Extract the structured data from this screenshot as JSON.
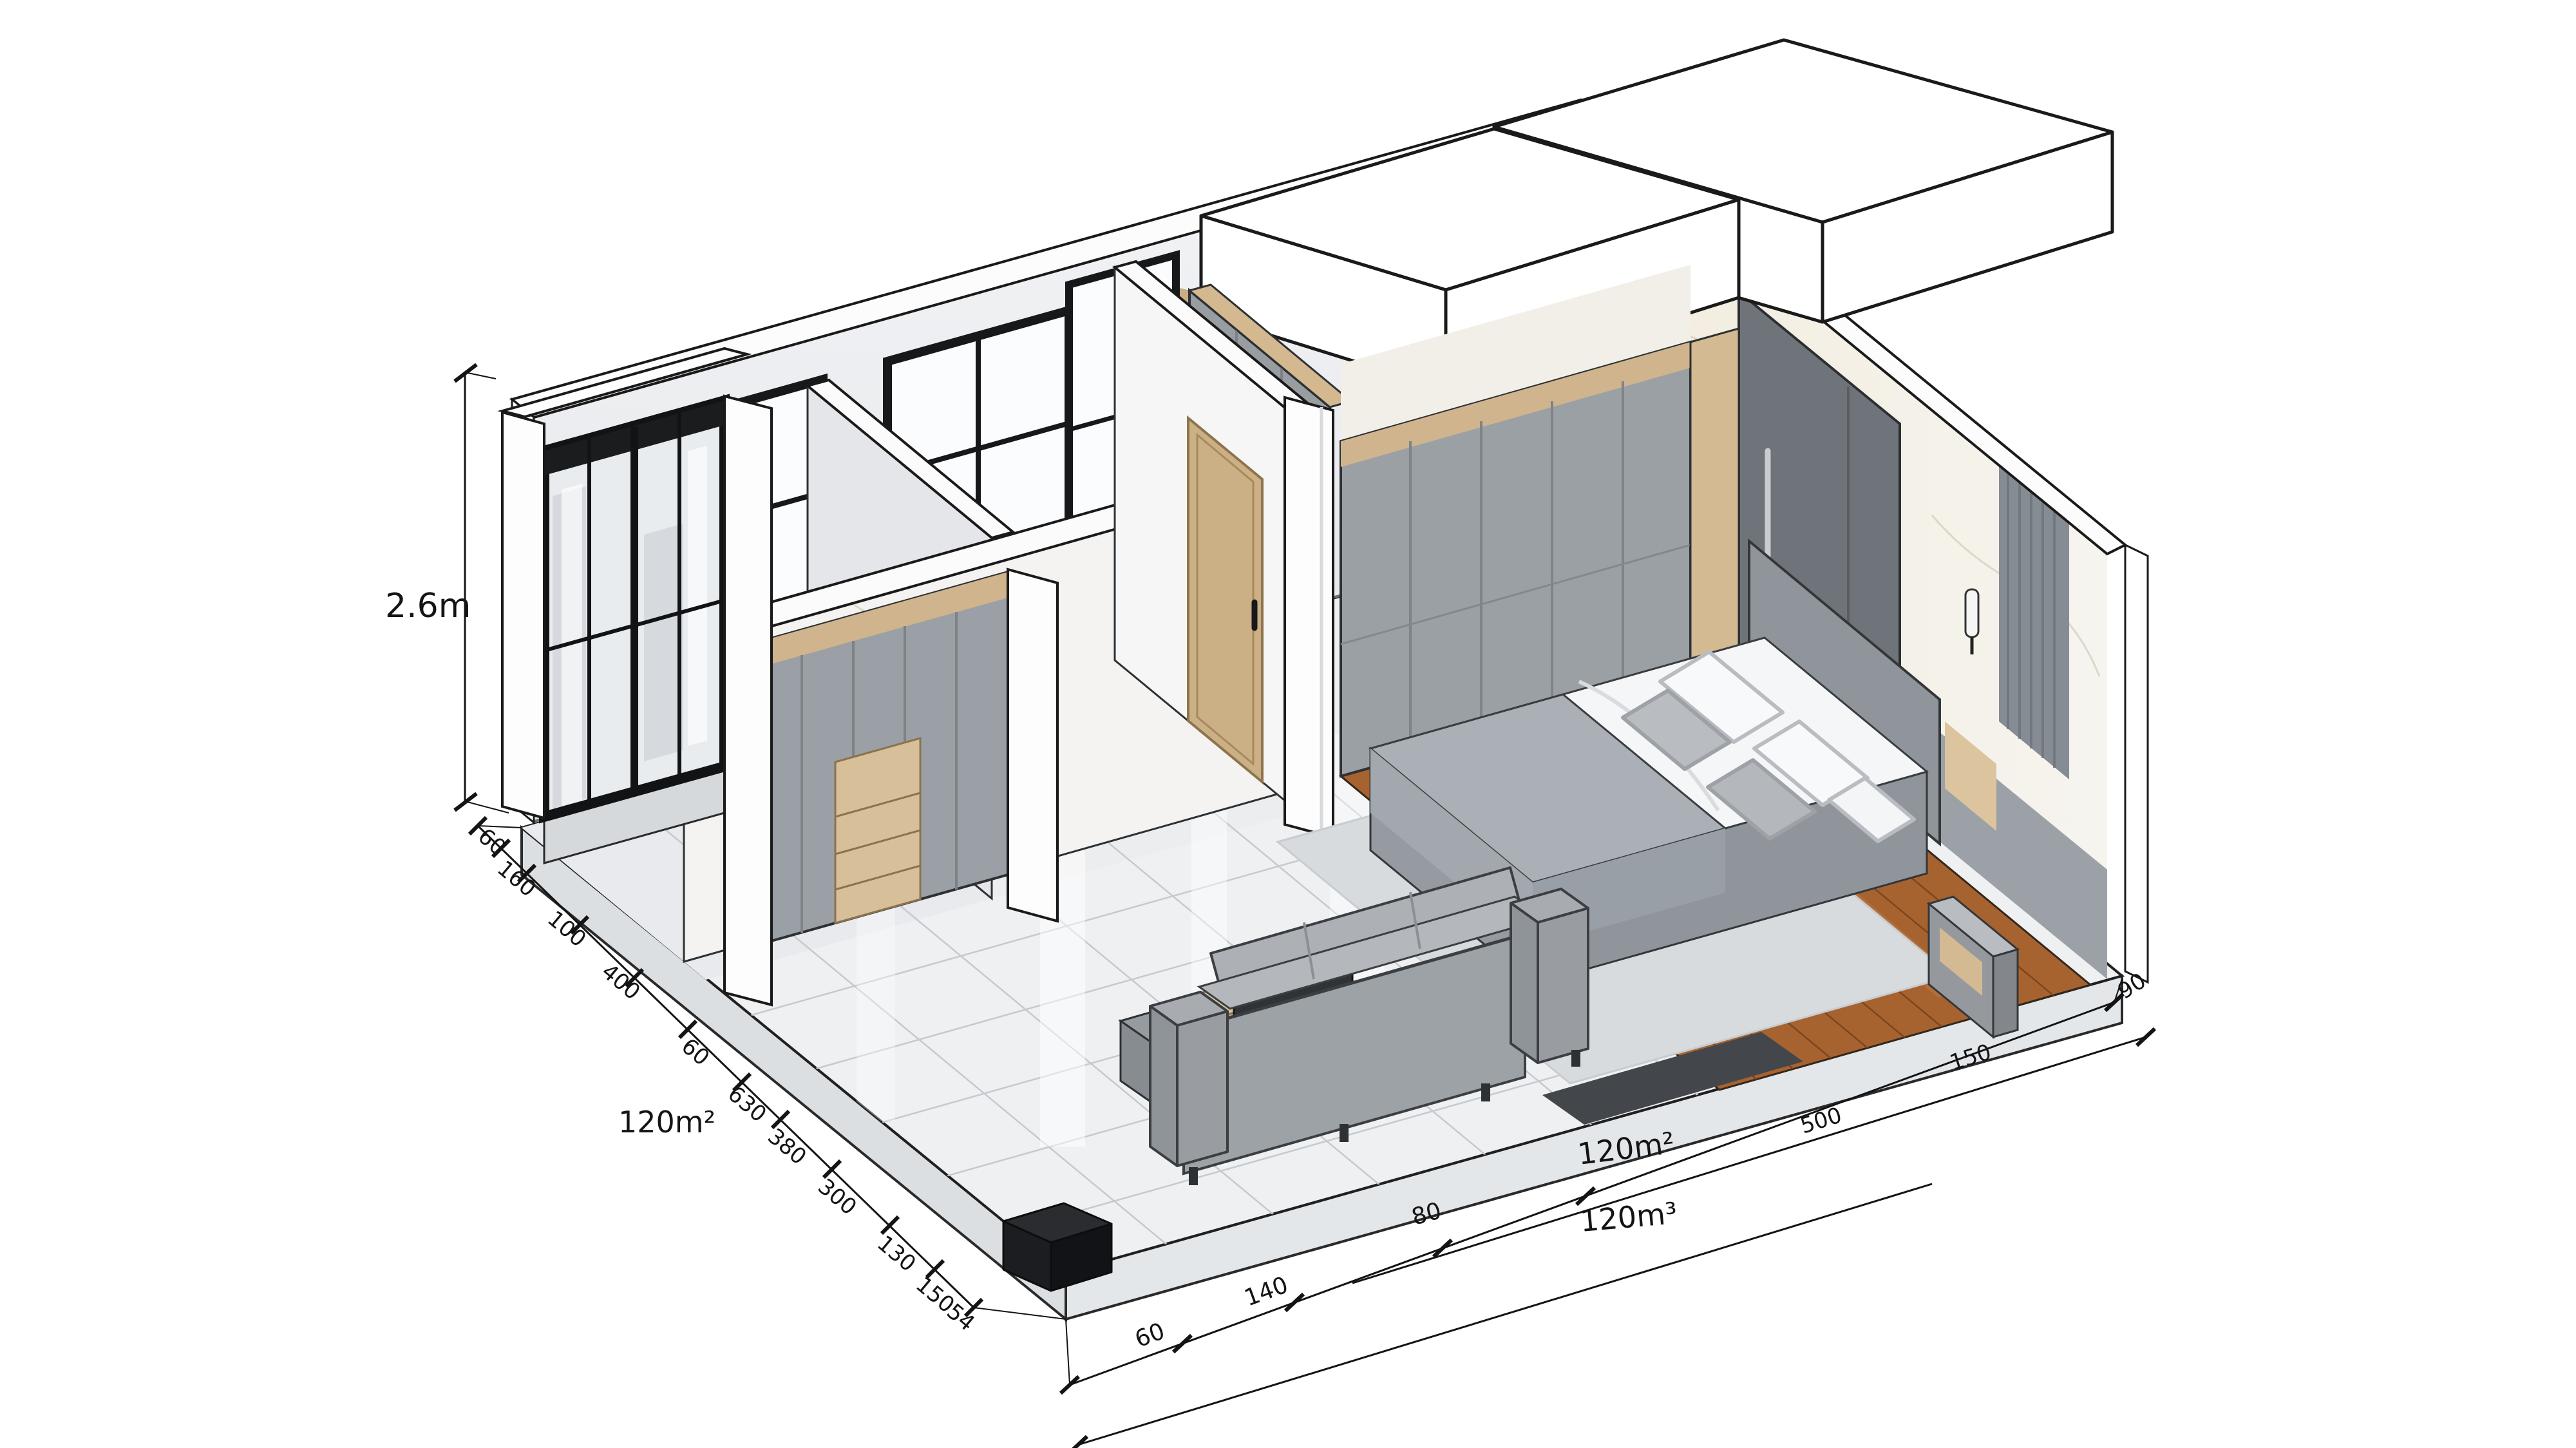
{
  "annotations": {
    "height": {
      "label": "2.6m"
    },
    "areas": {
      "left": "120m²",
      "center": "120m²",
      "volume": "120m³"
    },
    "left_chain": [
      "60",
      "160",
      "100",
      "400",
      "60",
      "630",
      "380",
      "300",
      "130",
      "150",
      "54"
    ],
    "bottom_chain": [
      "60",
      "140",
      "80"
    ],
    "right_chain": [
      "500",
      "150",
      "90"
    ]
  },
  "palette": {
    "background": "#ffffff",
    "outline": "#1a1a1a",
    "wall_white": "#fafafa",
    "wall_shadow": "#e7e9ec",
    "marble_tile": "#eef0f2",
    "grout": "#c5cad0",
    "wood_floor": "#a7632f",
    "wood_seam": "#7d451e",
    "furniture_gray": "#9ba0a5",
    "accent_tan": "#cfb48d",
    "fabric_gray": "#aab0b6",
    "glass_frame": "#17181a",
    "curtain_gray": "#868c93"
  }
}
